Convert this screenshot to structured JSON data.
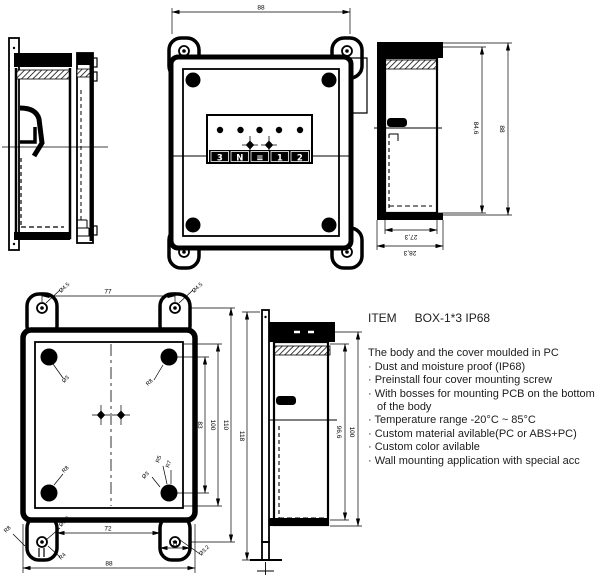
{
  "product": {
    "item_label": "ITEM",
    "item_value": "BOX-1*3 IP68",
    "intro": "The body and the cover moulded in PC",
    "features": [
      "· Dust and moisture proof (IP68)",
      "· Preinstall four cover mounting screw",
      "· With bosses for mounting PCB on the bottom of the body",
      "· Temperature range -20°C ~ 85°C",
      "· Custom material avilable(PC or ABS+PC)",
      "· Custom color avilable",
      "· Wall mounting application with special acc"
    ]
  },
  "drawing": {
    "top_view": {
      "width": "88",
      "terminals": [
        "3",
        "N",
        "≡",
        "1",
        "2"
      ]
    },
    "side_view": {
      "height_inner": "84,6",
      "height_outer": "88",
      "depth_inner": "27,3",
      "depth_outer": "28,3"
    },
    "back_view": {
      "hole_span": "77",
      "hole_dia": "Ø4.5",
      "boss_dia": "Ø3",
      "corner_radius": "R8",
      "radius_r5": "R5",
      "radius_r7": "R7",
      "radius_r4": "R4",
      "mount_hole_dia": "Ø3.2",
      "height_inner": "83",
      "height_mid": "100",
      "height_outer": "110",
      "ear_span": "72",
      "ear_width": "11",
      "overall_width": "88"
    },
    "profile_view": {
      "overall_height": "118",
      "height_inner": "96,6",
      "height_outer": "100"
    }
  },
  "colors": {
    "line": "#000000",
    "background": "#ffffff",
    "text": "#1c1c1c"
  }
}
